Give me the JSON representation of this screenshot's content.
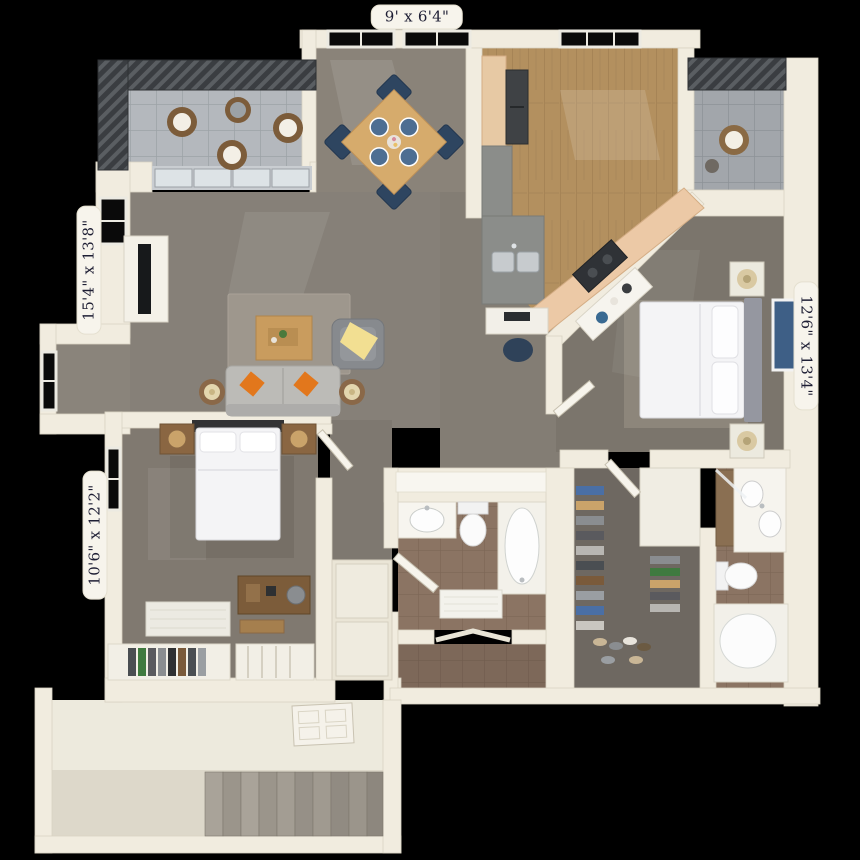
{
  "title": "3D apartment floor plan",
  "labels": {
    "top": {
      "text": "9' x 6'4\""
    },
    "left_upper": {
      "text": "15'4\" x 13'8\""
    },
    "left_lower": {
      "text": "10'6\" x 12'2\""
    },
    "right": {
      "text": "12'6\" x 13'4\""
    }
  },
  "palette": {
    "background": "#000000",
    "wall": "#f1ecdf",
    "carpet": "#867f76",
    "wood_floor": "#b3905f",
    "bath_tile": "#8b7463",
    "balcony_tile": "#b4b8bd",
    "railing": "#3a3d41",
    "label_bg": "#f7f4ec",
    "label_text": "#1e1e34",
    "accent_pillow": "#e0761e",
    "accent_throw": "#f2df92",
    "accent_art": "#3e5f86"
  }
}
